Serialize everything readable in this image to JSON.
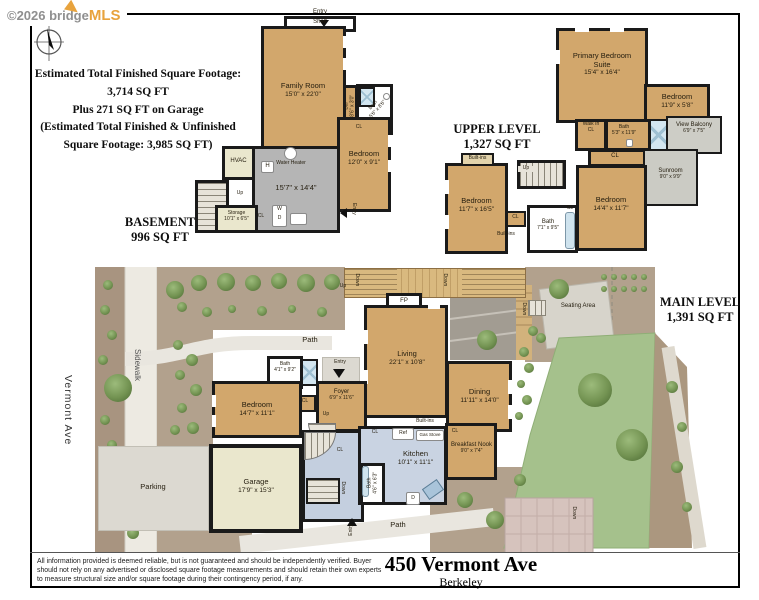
{
  "copyright": {
    "prefix": "©2026 bridge",
    "brand": "MLS"
  },
  "summary": {
    "lines": [
      "Estimated Total Finished Square Footage:",
      "3,714 SQ FT",
      "Plus 271 SQ FT on Garage",
      "(Estimated Total Finished & Unfinished",
      "Square Footage: 3,985 SQ FT)"
    ]
  },
  "levels": {
    "basement": {
      "title": "BASEMENT",
      "sqft": "996 SQ FT"
    },
    "upper": {
      "title": "UPPER LEVEL",
      "sqft": "1,327 SQ FT"
    },
    "main": {
      "title": "MAIN LEVEL",
      "sqft": "1,391 SQ FT"
    }
  },
  "basement": {
    "entry_top": "Entry",
    "shelf": "Shelf",
    "family_room": {
      "name": "Family Room",
      "dims": "15'0\" x 22'0\""
    },
    "bar": {
      "name": "Bar",
      "dims": "8'6\" x 3'0\""
    },
    "bath": {
      "name": "Bath",
      "dims": "5'6\" x 8'6\""
    },
    "cl_bath": "CL",
    "hvac": "HVAC",
    "h_marker": "H",
    "water_heater": "Water Heater",
    "utility_dims": "15'7\" x 14'4\"",
    "bedroom": {
      "name": "Bedroom",
      "dims": "12'0\" x 9'1\""
    },
    "entry_side": "Entry",
    "up": "Up",
    "storage": {
      "name": "Storage",
      "dims": "10'1\" x 6'5\""
    },
    "cl_hall": "CL",
    "washer": "W",
    "dryer": "D"
  },
  "upper": {
    "primary_suite": {
      "name": "Primary Bedroom Suite",
      "dims": "15'4\" x 16'4\""
    },
    "bedroom_right": {
      "name": "Bedroom",
      "dims": "11'9\" x 5'8\""
    },
    "walk_in_cl": "Walk In CL",
    "bath_top": {
      "name": "Bath",
      "dims": "5'3\" x 11'9\""
    },
    "view_balcony": {
      "name": "View Balcony",
      "dims": "6'9\" x 7'5\""
    },
    "cl_hall": "CL",
    "sunroom": {
      "name": "Sunroom",
      "dims": "9'0\" x 9'9\""
    },
    "bedroom_center": {
      "name": "Bedroom",
      "dims": "14'4\" x 11'7\""
    },
    "cl_center": "CL",
    "bath_center": {
      "name": "Bath",
      "dims": "7'1\" x 9'5\""
    },
    "cl_left": "CL",
    "built_ins_bottom": "Built-ins",
    "bedroom_left": {
      "name": "Bedroom",
      "dims": "11'7\" x 16'5\""
    },
    "built_ins_top": "Built-ins",
    "up": "Up"
  },
  "main": {
    "deck_up": "Up",
    "deck_down_left": "Down",
    "deck_down_right": "Down",
    "fireplace": "FP",
    "living": {
      "name": "Living",
      "dims": "22'1\" x 10'8\""
    },
    "dining": {
      "name": "Dining",
      "dims": "11'11\" x 14'0\""
    },
    "bath_front": {
      "name": "Bath",
      "dims": "4'1\" x 9'2\""
    },
    "entry_front": "Entry",
    "foyer": {
      "name": "Foyer",
      "dims": "6'9\" x 11'6\""
    },
    "cl_foyer": "CL",
    "up_foyer": "Up",
    "built_ins": "Built-ins",
    "bedroom": {
      "name": "Bedroom",
      "dims": "14'7\" x 11'1\""
    },
    "cl_hall": "CL",
    "cl_kitchen": "CL",
    "down_stairs": "Down",
    "garage": {
      "name": "Garage",
      "dims": "17'9\" x 15'3\""
    },
    "parking": "Parking",
    "kitchen": {
      "name": "Kitchen",
      "dims": "10'1\" x 11'1\""
    },
    "ref": "Ref",
    "gas_stove": "Gas Stove",
    "dishwasher": "D",
    "bath_rear": {
      "name": "Bath",
      "dims": "4'6\" x 6'3\""
    },
    "breakfast_nook": {
      "name": "Breakfast Nook",
      "dims": "9'0\" x 7'4\""
    },
    "cl_nook": "CL",
    "entry_rear": "Entry",
    "seating_area": "Seating Area",
    "down_seating": "Down",
    "down_patio": "Down",
    "path_front": "Path",
    "path_rear": "Path",
    "sidewalk": "Sidewalk",
    "street": "Vermont Ave"
  },
  "address": {
    "street": "450 Vermont Ave",
    "city": "Berkeley"
  },
  "disclaimer": "All information provided is deemed reliable, but is not guaranteed and should be independently verified. Buyer should not rely on any advertised or disclosed square footage measurements and should retain their own experts to measure structural size and/or square footage during their contingency period, if any.",
  "colors": {
    "wall": "#1a1a1a",
    "room_tan": "#d2a76c",
    "unfinished_gray": "#b5b5b5",
    "utility_cream": "#eae7cd",
    "hall_blue": "#c9d3e2",
    "lawn_green": "#a5c18c",
    "bed_brown": "#a89480",
    "path_light": "#e9e6df",
    "brand_orange": "#e8a33d"
  }
}
